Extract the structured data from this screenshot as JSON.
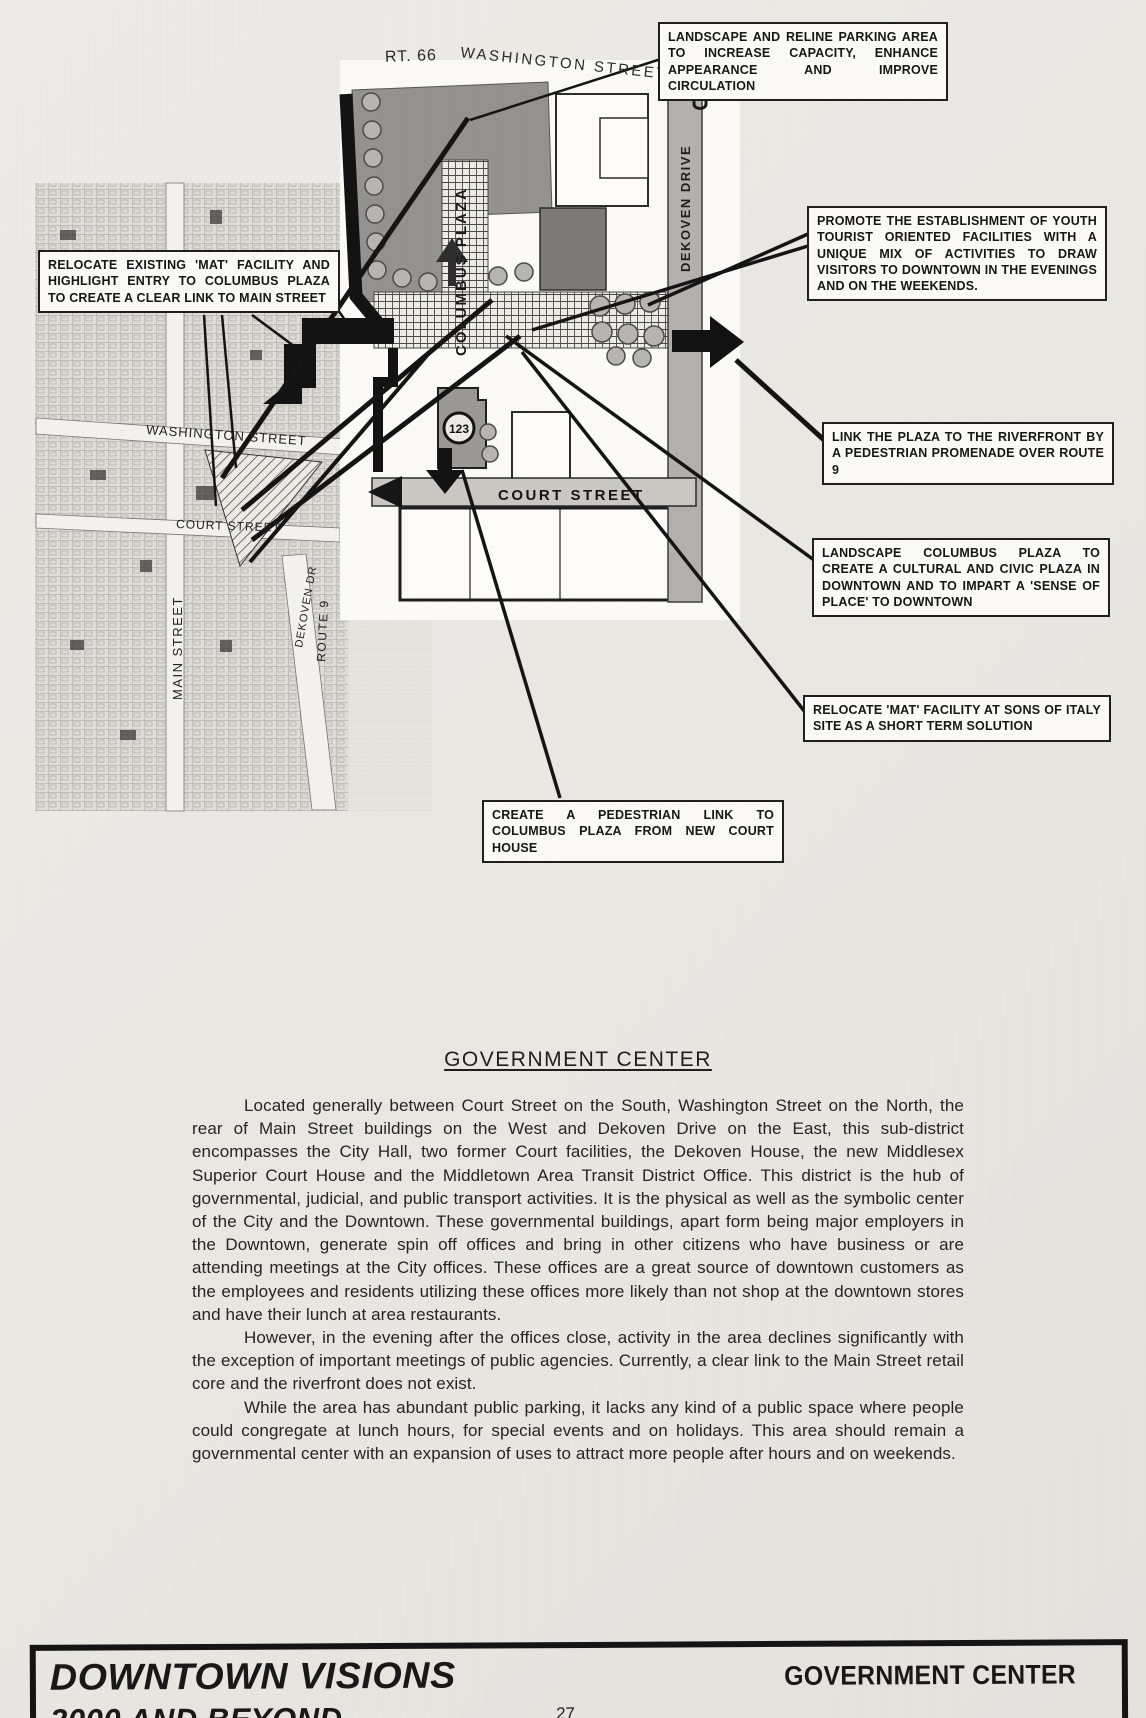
{
  "figure": {
    "map_labels": {
      "rt66": "RT. 66",
      "washington_street_top": "WASHINGTON STREET",
      "washington_street_left": "WASHINGTON STREET",
      "court_street_left": "COURT STREET",
      "main_street": "MAIN STREET",
      "dekoven_dr_left": "DEKOVEN DR",
      "route9": "ROUTE 9",
      "columbus_plaza": "COLUMBUS PLAZA",
      "dekoven_drive": "DEKOVEN DRIVE",
      "court_street_plan": "COURT STREET",
      "building_123": "123"
    },
    "callouts": [
      {
        "id": "landscape-parking",
        "text": "LANDSCAPE AND RELINE PARKING AREA TO INCREASE CAPACITY, ENHANCE APPEARANCE AND IMPROVE CIRCULATION"
      },
      {
        "id": "relocate-existing-mat",
        "text": "RELOCATE EXISTING 'MAT' FACILITY AND HIGHLIGHT ENTRY TO COLUMBUS PLAZA TO CREATE A CLEAR LINK TO MAIN STREET"
      },
      {
        "id": "promote-youth",
        "text": "PROMOTE THE ESTABLISHMENT OF YOUTH TOURIST ORIENTED FACILITIES WITH A UNIQUE MIX OF ACTIVITIES TO DRAW VISITORS TO DOWNTOWN IN THE EVENINGS AND ON THE WEEKENDS."
      },
      {
        "id": "link-riverfront",
        "text": "LINK THE PLAZA TO THE RIVERFRONT BY A PEDESTRIAN PROMENADE OVER ROUTE 9"
      },
      {
        "id": "landscape-columbus",
        "text": "LANDSCAPE COLUMBUS PLAZA TO CREATE A CULTURAL AND CIVIC PLAZA IN DOWNTOWN AND TO IMPART A 'SENSE OF PLACE' TO DOWNTOWN"
      },
      {
        "id": "relocate-mat-sons",
        "text": "RELOCATE 'MAT' FACILITY AT SONS OF ITALY SITE AS A SHORT TERM SOLUTION"
      },
      {
        "id": "pedestrian-link",
        "text": "CREATE A PEDESTRIAN LINK TO COLUMBUS PLAZA FROM NEW COURT HOUSE"
      }
    ]
  },
  "section": {
    "heading": "GOVERNMENT CENTER",
    "paragraphs": [
      "Located generally between Court Street on the South, Washington Street on the North, the rear of Main Street buildings on the West and Dekoven Drive on the East, this sub-district encompasses the City Hall, two former Court facilities, the Dekoven House, the new Middlesex Superior Court House and the Middletown Area Transit District Office.  This district is the hub of governmental, judicial, and public transport activities.  It is the physical as well as the symbolic center of the City and the Downtown.  These governmental buildings, apart form being major employers in the Downtown, generate spin off offices and bring in other citizens who have business or are attending meetings at the City offices.  These offices are a great source of downtown customers as the employees and residents utilizing these offices more likely than not shop at the downtown stores and have their lunch at area restaurants.",
      "However, in the evening after the offices close, activity in the area declines significantly with the exception of important meetings of public agencies.  Currently, a clear link to the Main Street retail core and the riverfront does not exist.",
      "While the area has abundant public parking, it lacks any kind of a public space where people could congregate at lunch hours, for special events and on holidays.  This area should remain a governmental center with an expansion of uses to attract more people after hours and on weekends."
    ]
  },
  "footer": {
    "title_line1": "DOWNTOWN VISIONS",
    "title_line2": "2000 AND BEYOND",
    "page_number": "27",
    "section_title": "GOVERNMENT CENTER"
  }
}
